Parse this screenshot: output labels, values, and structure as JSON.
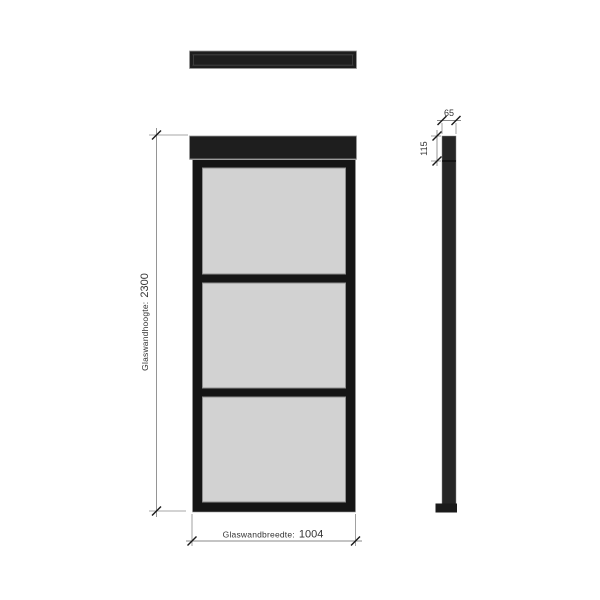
{
  "colors": {
    "background": "#ffffff",
    "frame": "#1e1e1e",
    "frame_dark": "#151515",
    "glass": "#d2d2d2",
    "glass_edge": "#8f8f8f",
    "outline": "#9a9a9a",
    "dim_line": "#8a8a8a",
    "tick": "#1a1a1a",
    "text": "#333333"
  },
  "views": {
    "front": {
      "glass_panel_count": 3
    }
  },
  "dimensions": {
    "height": {
      "label": "Glaswandhoogte:",
      "value": "2300"
    },
    "width": {
      "label": "Glaswandbreedte:",
      "value": "1004"
    },
    "profile_width": {
      "value": "65"
    },
    "profile_top_section": {
      "value": "115"
    }
  }
}
